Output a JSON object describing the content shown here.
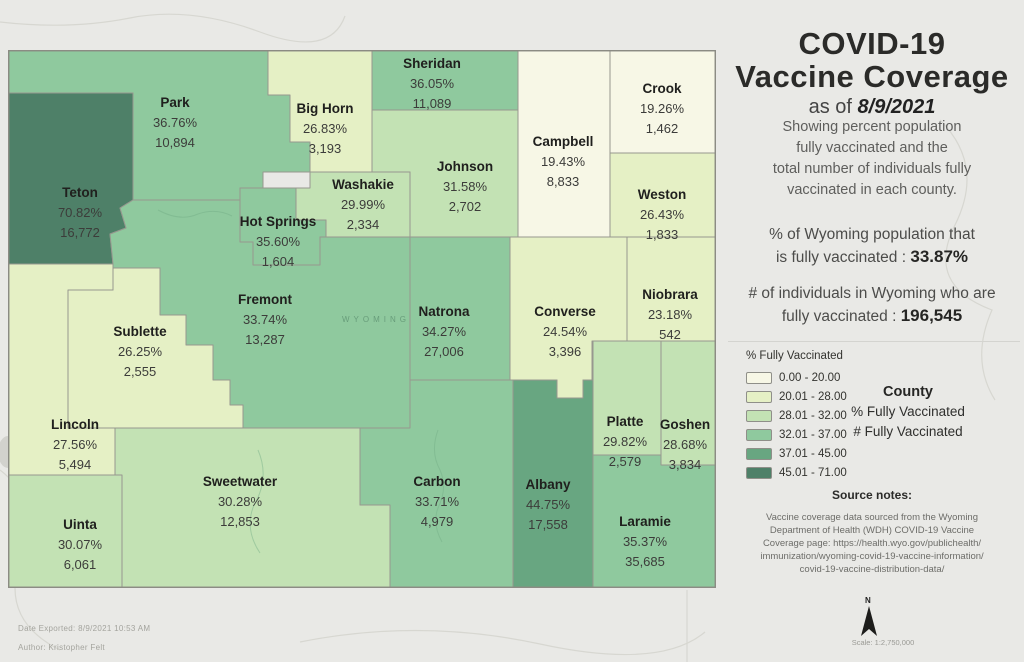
{
  "panel": {
    "title_line1": "COVID-19",
    "title_line2": "Vaccine Coverage",
    "as_of_prefix": "as of ",
    "as_of_date": "8/9/2021",
    "description_lines": [
      "Showing percent population",
      "fully vaccinated and the",
      "total number of individuals fully",
      "vaccinated in each county."
    ],
    "stat_pct": {
      "line1": "% of Wyoming population that",
      "line2_prefix": "is fully vaccinated : ",
      "value": "33.87%"
    },
    "stat_count": {
      "line1": "# of individuals in Wyoming who are",
      "line2_prefix": "fully vaccinated : ",
      "value": "196,545"
    },
    "legend": {
      "title": "% Fully Vaccinated",
      "classes": [
        {
          "range": "0.00 - 20.00",
          "color": "#f7f7e6"
        },
        {
          "range": "20.01 - 28.00",
          "color": "#e5f0c5"
        },
        {
          "range": "28.01 - 32.00",
          "color": "#c3e2b4"
        },
        {
          "range": "32.01 - 37.00",
          "color": "#8fc99e"
        },
        {
          "range": "37.01 - 45.00",
          "color": "#68a681"
        },
        {
          "range": "45.01 - 71.00",
          "color": "#4e8068"
        }
      ]
    },
    "label_key": {
      "title": "County",
      "line2": "% Fully Vaccinated",
      "line3": "# Fully Vaccinated"
    },
    "source_notes": {
      "title": "Source notes:",
      "lines": [
        "Vaccine coverage data sourced from the Wyoming",
        "Department of Health (WDH) COVID-19 Vaccine",
        "Coverage page: https://health.wyo.gov/publichealth/",
        "immunization/wyoming-covid-19-vaccine-information/",
        "covid-19-vaccine-distribution-data/"
      ]
    }
  },
  "map": {
    "state_watermark": "WYOMING",
    "counties": [
      {
        "id": "park",
        "name": "Park",
        "pct": "36.76%",
        "count": "10,894",
        "class": 3
      },
      {
        "id": "teton",
        "name": "Teton",
        "pct": "70.82%",
        "count": "16,772",
        "class": 5
      },
      {
        "id": "bighorn",
        "name": "Big Horn",
        "pct": "26.83%",
        "count": "3,193",
        "class": 1
      },
      {
        "id": "sheridan",
        "name": "Sheridan",
        "pct": "36.05%",
        "count": "11,089",
        "class": 3
      },
      {
        "id": "crook",
        "name": "Crook",
        "pct": "19.26%",
        "count": "1,462",
        "class": 0
      },
      {
        "id": "campbell",
        "name": "Campbell",
        "pct": "19.43%",
        "count": "8,833",
        "class": 0
      },
      {
        "id": "johnson",
        "name": "Johnson",
        "pct": "31.58%",
        "count": "2,702",
        "class": 2
      },
      {
        "id": "washakie",
        "name": "Washakie",
        "pct": "29.99%",
        "count": "2,334",
        "class": 2
      },
      {
        "id": "hotsprings",
        "name": "Hot Springs",
        "pct": "35.60%",
        "count": "1,604",
        "class": 3
      },
      {
        "id": "weston",
        "name": "Weston",
        "pct": "26.43%",
        "count": "1,833",
        "class": 1
      },
      {
        "id": "fremont",
        "name": "Fremont",
        "pct": "33.74%",
        "count": "13,287",
        "class": 3
      },
      {
        "id": "natrona",
        "name": "Natrona",
        "pct": "34.27%",
        "count": "27,006",
        "class": 3
      },
      {
        "id": "converse",
        "name": "Converse",
        "pct": "24.54%",
        "count": "3,396",
        "class": 1
      },
      {
        "id": "niobrara",
        "name": "Niobrara",
        "pct": "23.18%",
        "count": "542",
        "class": 1
      },
      {
        "id": "sublette",
        "name": "Sublette",
        "pct": "26.25%",
        "count": "2,555",
        "class": 1
      },
      {
        "id": "lincoln",
        "name": "Lincoln",
        "pct": "27.56%",
        "count": "5,494",
        "class": 1
      },
      {
        "id": "uinta",
        "name": "Uinta",
        "pct": "30.07%",
        "count": "6,061",
        "class": 2
      },
      {
        "id": "sweetwater",
        "name": "Sweetwater",
        "pct": "30.28%",
        "count": "12,853",
        "class": 2
      },
      {
        "id": "carbon",
        "name": "Carbon",
        "pct": "33.71%",
        "count": "4,979",
        "class": 3
      },
      {
        "id": "albany",
        "name": "Albany",
        "pct": "44.75%",
        "count": "17,558",
        "class": 4
      },
      {
        "id": "platte",
        "name": "Platte",
        "pct": "29.82%",
        "count": "2,579",
        "class": 2
      },
      {
        "id": "goshen",
        "name": "Goshen",
        "pct": "28.68%",
        "count": "3,834",
        "class": 2
      },
      {
        "id": "laramie",
        "name": "Laramie",
        "pct": "35.37%",
        "count": "35,685",
        "class": 3
      }
    ]
  },
  "footer": {
    "date_exported": "Date Exported: 8/9/2021 10:53 AM",
    "author": "Author: Kristopher Felt",
    "north_label": "N",
    "scale": "Scale: 1:2,750,000"
  }
}
